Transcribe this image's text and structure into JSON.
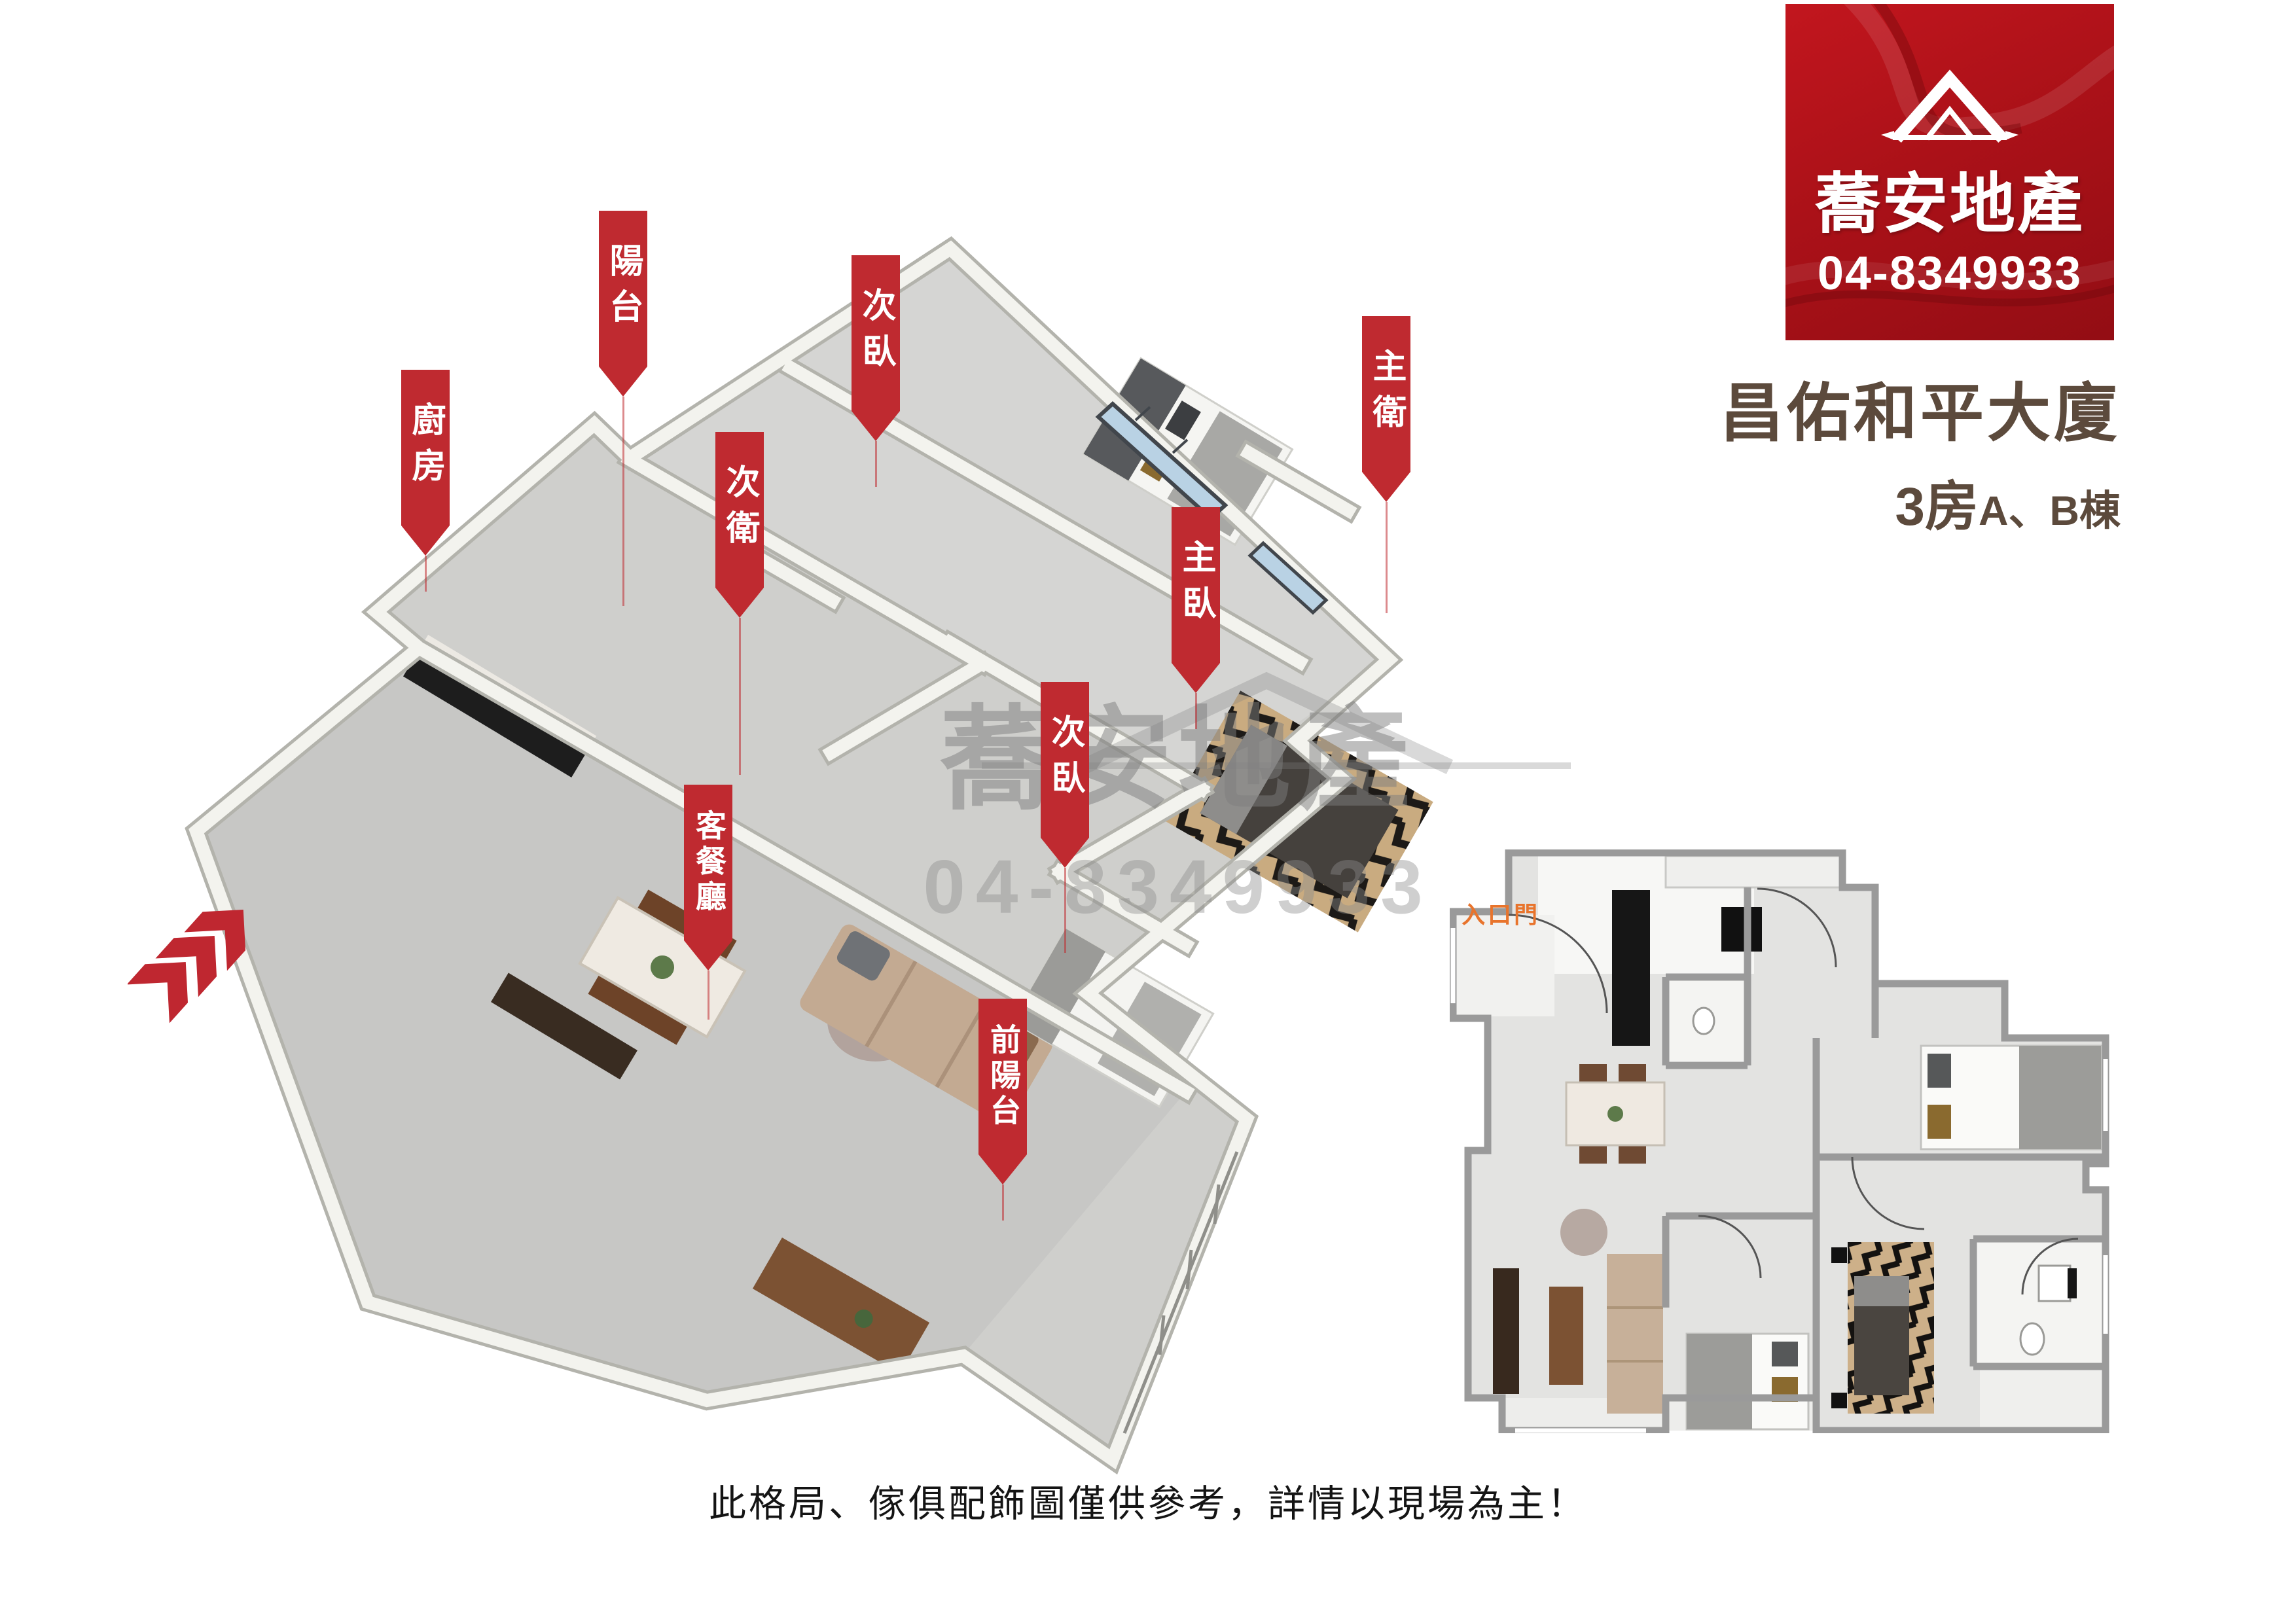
{
  "colors": {
    "accent_red": "#bf2a30",
    "logo_red": "#ab1118",
    "title_brown": "#5c4a3c",
    "watermark_gray": "#8c8c8c",
    "entry_orange": "#e8742c"
  },
  "logo_card": {
    "icon": "house-roof-icon",
    "brand": "蕎安地產",
    "phone": "04-8349933"
  },
  "listing": {
    "title": "昌佑和平大廈",
    "subtitle_rooms": "3房",
    "subtitle_block": "A、B棟"
  },
  "room_labels": [
    {
      "id": "kitchen",
      "text": "廚房"
    },
    {
      "id": "balcony",
      "text": "陽台"
    },
    {
      "id": "sec-bedroom-1",
      "text": "次臥"
    },
    {
      "id": "sec-bath",
      "text": "次衛"
    },
    {
      "id": "master-bath",
      "text": "主衛"
    },
    {
      "id": "master-bedroom",
      "text": "主臥"
    },
    {
      "id": "sec-bedroom-2",
      "text": "次臥"
    },
    {
      "id": "living-dining",
      "text": "客餐廳"
    },
    {
      "id": "front-balcony",
      "text": "前陽台"
    }
  ],
  "watermark": {
    "line1": "蕎安地產",
    "line2": "04-8349933"
  },
  "plan_2d": {
    "entry_door_label": "入口門"
  },
  "footer": {
    "disclaimer": "此格局、傢俱配飾圖僅供參考，詳情以現場為主！"
  }
}
